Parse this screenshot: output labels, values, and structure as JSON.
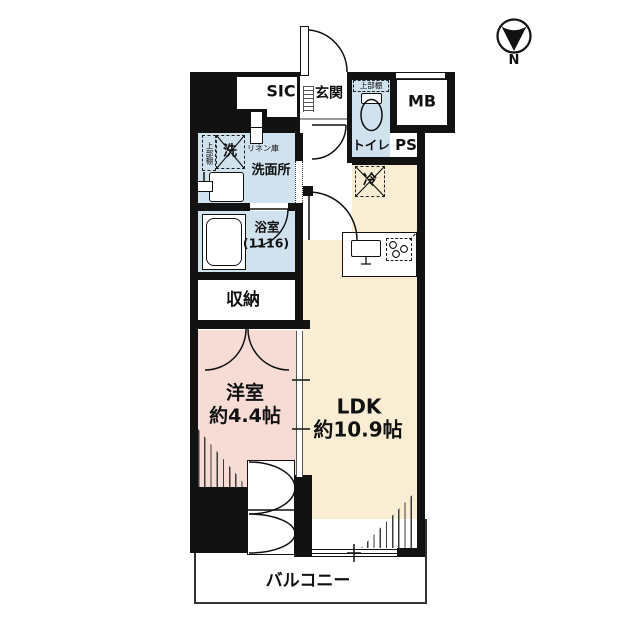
{
  "title": "apartment-floor-plan",
  "compass": {
    "label": "N"
  },
  "colors": {
    "wall": "#121212",
    "wet_area_blue": "#cfe2ee",
    "ldk_cream": "#f9eed4",
    "room_pink": "#f7dcd6",
    "balcony_line": "#333333"
  },
  "rooms": {
    "sic": {
      "label": "SIC"
    },
    "genkan": {
      "label": "玄関"
    },
    "toilet": {
      "label": "トイレ",
      "shelf_label": "上部棚"
    },
    "mb": {
      "label": "MB"
    },
    "ps": {
      "label": "PS"
    },
    "washroom": {
      "label": "洗面所",
      "washer_label": "洗",
      "shelf_label": "上部棚",
      "linen_label": "リネン庫"
    },
    "bathroom": {
      "label": "浴室",
      "size_label": "(1116)"
    },
    "fridge": {
      "label": "冷"
    },
    "storage": {
      "label": "収納"
    },
    "western_room": {
      "label": "洋室",
      "size_label": "約4.4帖"
    },
    "ldk": {
      "label": "LDK",
      "size_label": "約10.9帖"
    },
    "balcony": {
      "label": "バルコニー"
    }
  }
}
